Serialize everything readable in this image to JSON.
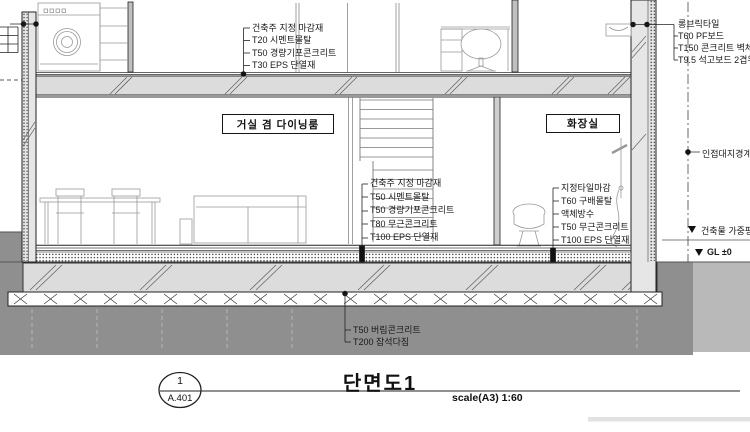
{
  "rooms": {
    "living": "거실 겸 다이닝룸",
    "bath": "화장실"
  },
  "callouts": {
    "roof_floor": [
      "건축주 지정 마감재",
      "T20 시멘트몰탈",
      "T50 경량기포콘크리트",
      "T30 EPS 단열재"
    ],
    "ext_wall": [
      "롱브릭타일",
      "T60 PF보드",
      "T150 콘크리트 벽체",
      "T9.5 석고보드 2겹위 지정"
    ],
    "gf_floor": [
      "건축주 지정 마감재",
      "T50 시멘트몰탈",
      "T50 경량기포콘크리트",
      "T80 무근콘크리트",
      "T100 EPS 단열재"
    ],
    "bath_floor": [
      "지정타일마감",
      "T60 구배몰탈",
      "액체방수",
      "T50 무근콘크리트",
      "T100 EPS 단열재"
    ],
    "foundation": [
      "T50 버림콘크리트",
      "T200 잡석다짐"
    ]
  },
  "markers": {
    "boundary": "인접대지경계선",
    "avg_ground": "건축물 가중평균",
    "gl": "GL ±0"
  },
  "title_block": {
    "num": "1",
    "sheet": "A.401",
    "title": "단면도1",
    "scale": "scale(A3) 1:60"
  },
  "colors": {
    "line": "#1a1a1a",
    "soil": "#8f8f8f",
    "soil_light": "#b9b9b9",
    "slab": "#dcdcdc",
    "wall": "#e6e6e6"
  }
}
